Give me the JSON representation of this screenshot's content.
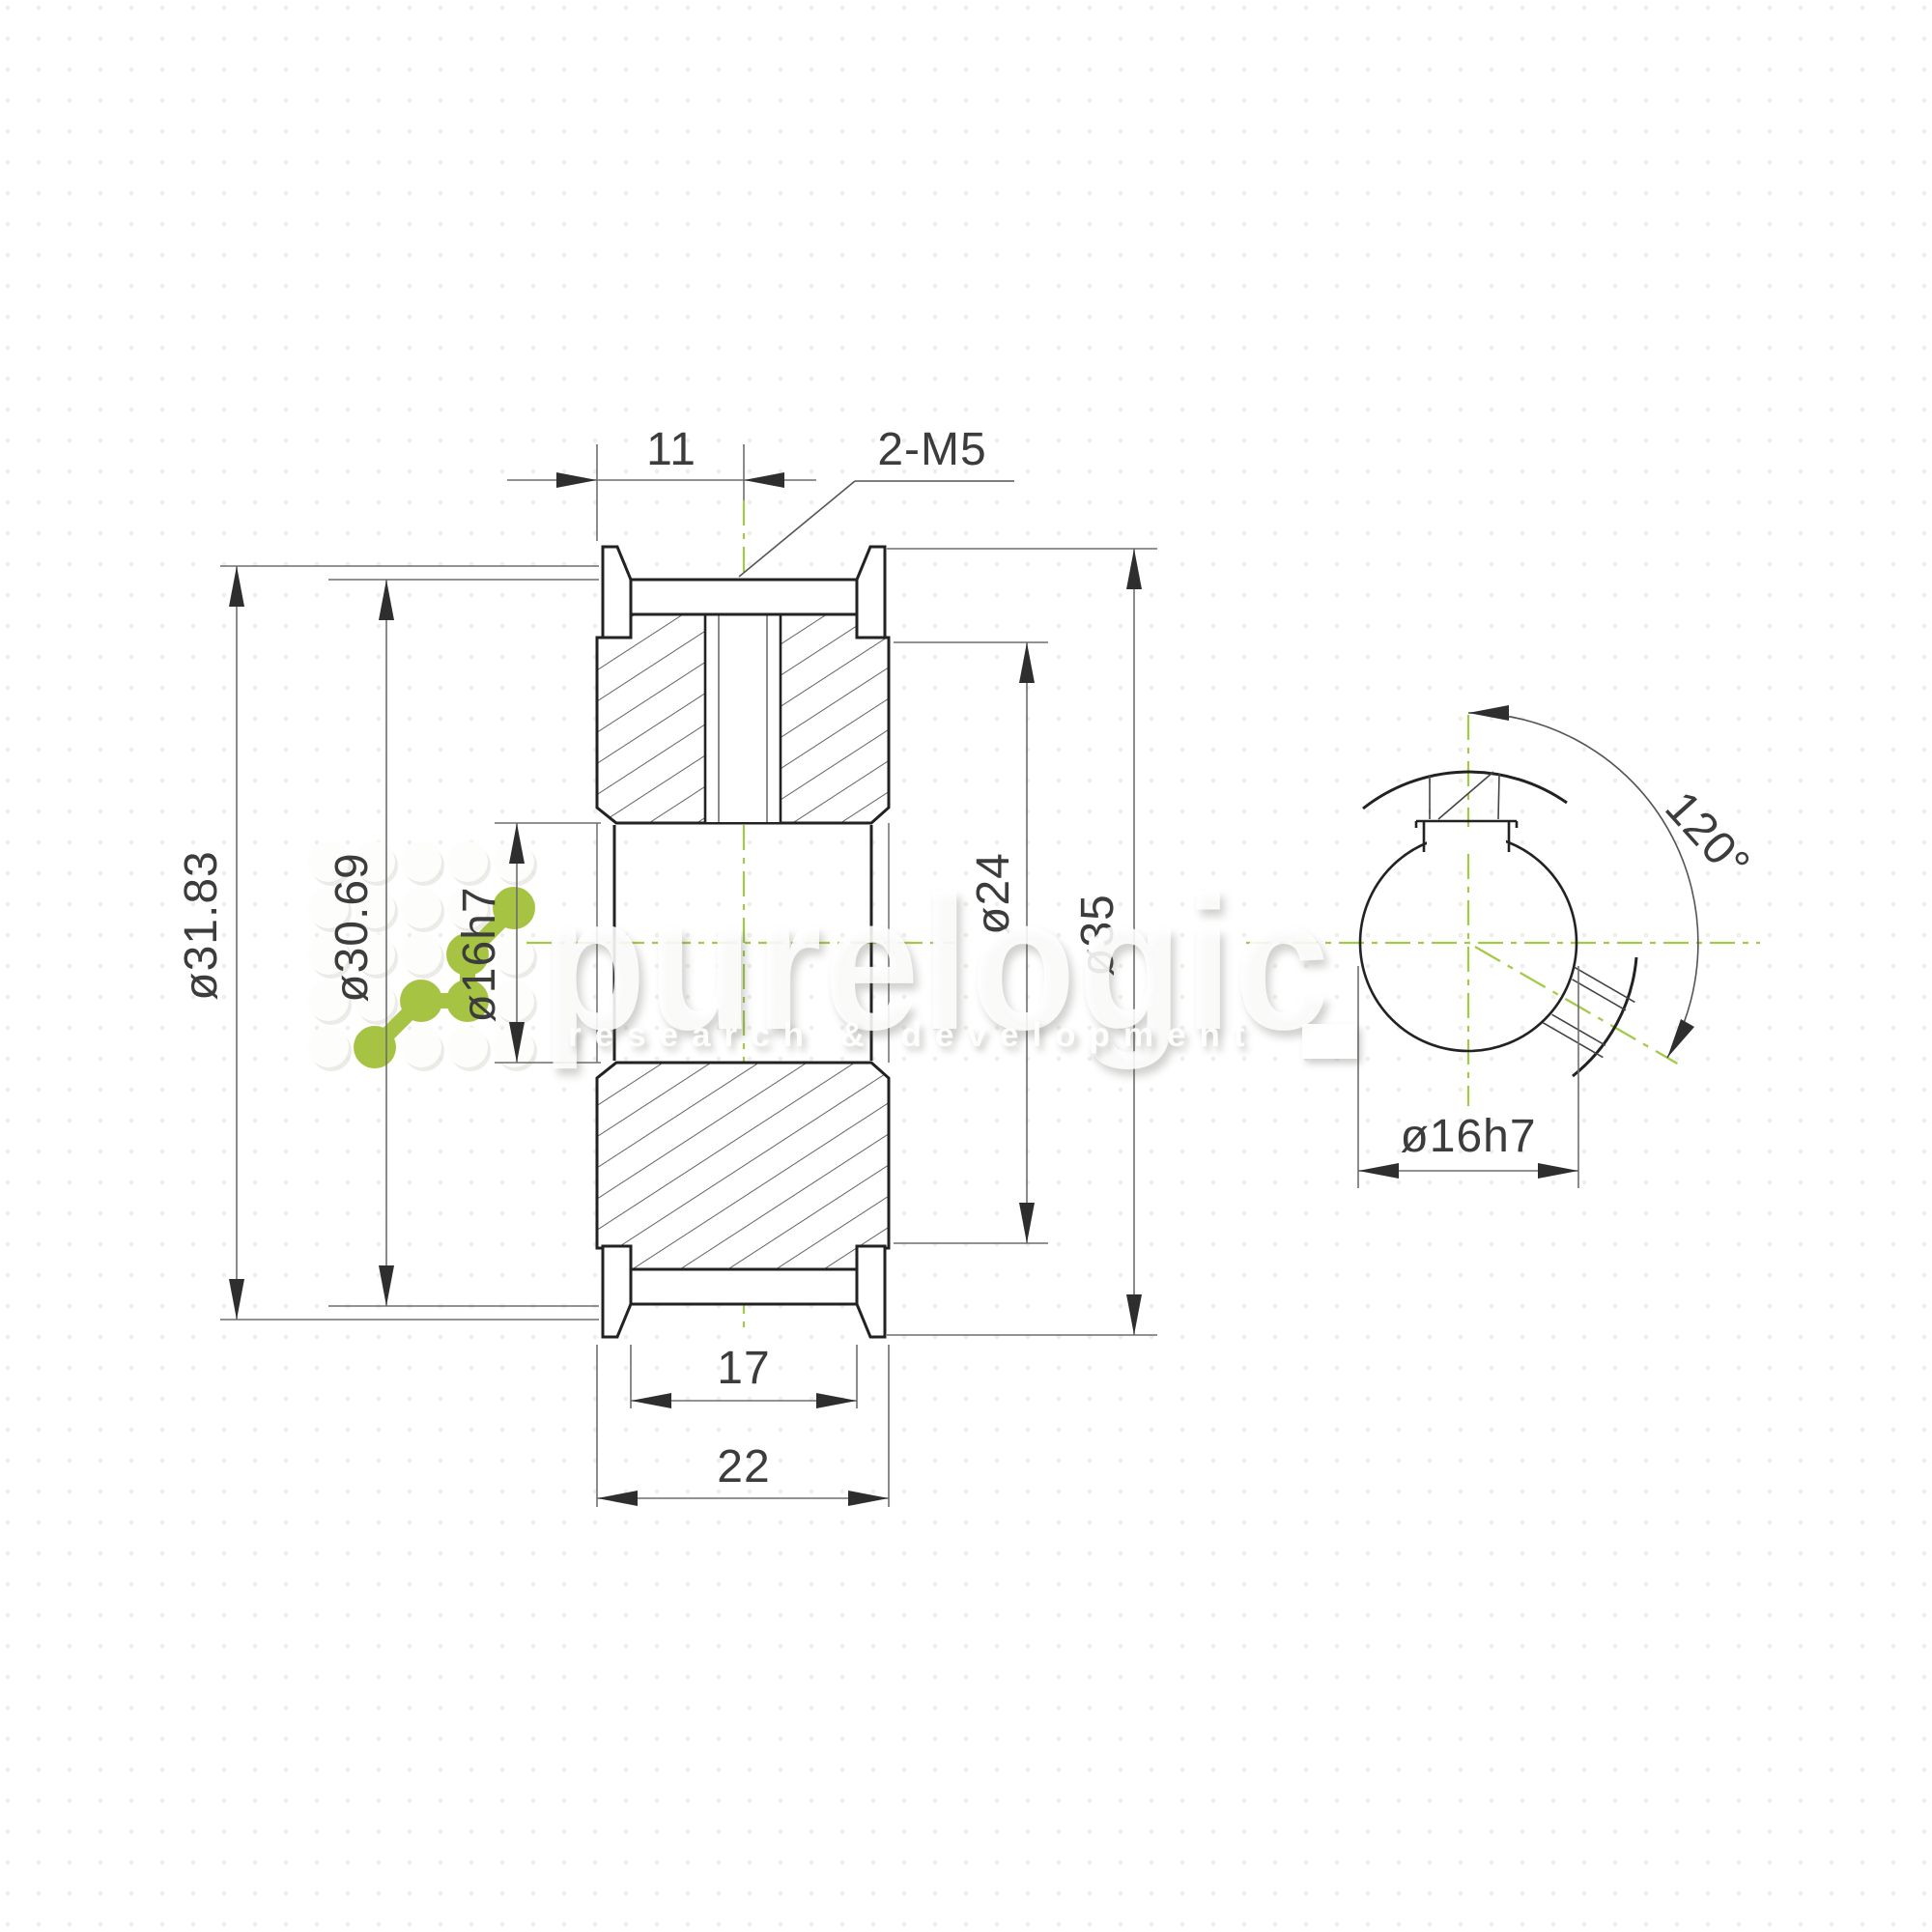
{
  "drawing": {
    "type": "timing-pulley technical drawing",
    "dims": {
      "hub_offset": "11",
      "thread_callout": "2-M5",
      "pitch_diameter": "ø31.83",
      "outside_diameter": "ø30.69",
      "bore_main": "ø16h7",
      "hub_diameter": "ø24",
      "flange_diameter": "ø35",
      "belt_width": "17",
      "total_width": "22",
      "setscrew_angle": "120°",
      "bore_side": "ø16h7"
    },
    "colors": {
      "accent_green": "#a6c343",
      "centerline_green": "#a2ca47",
      "outline": "#222222",
      "thin_line": "#555555",
      "dim_line": "#6e6e6e",
      "text": "#3c3c3c"
    }
  },
  "watermark": {
    "brand": "purelogic",
    "tagline": "research & development"
  }
}
